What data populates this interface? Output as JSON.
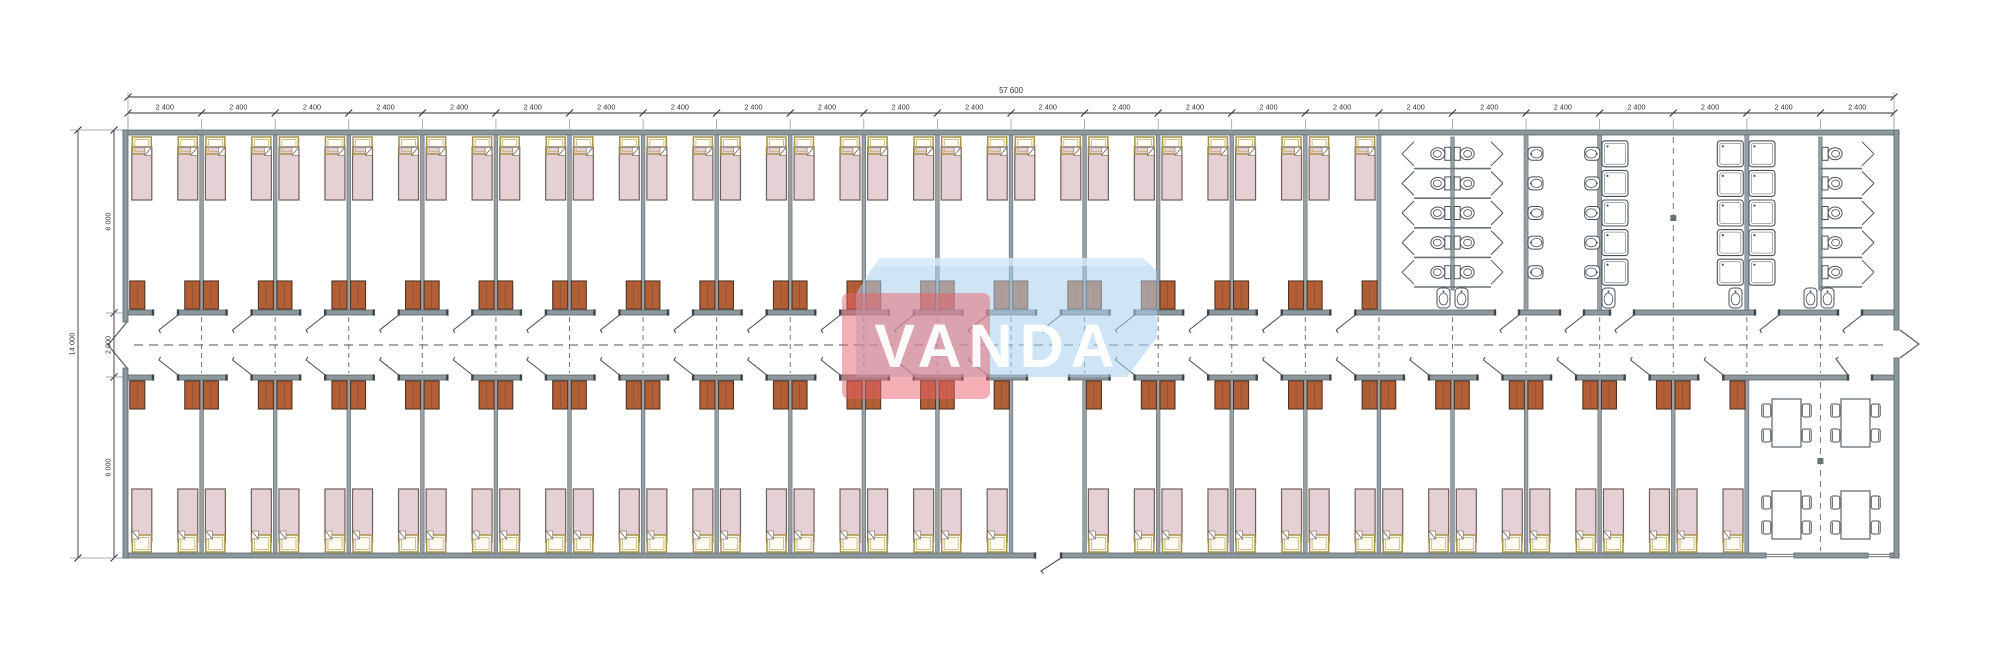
{
  "drawing": {
    "type": "architectural-floor-plan",
    "watermark": {
      "text": "VANDA",
      "red": "#e85f6a",
      "blue": "#a8d0ec",
      "red_rgba": "rgba(232,95,106,0.50)",
      "blue_rgba": "rgba(168,208,236,0.55)",
      "blue_light_rgba": "rgba(225,241,250,0.65)",
      "text_rgba": "rgba(255,255,255,0.95)"
    },
    "dimensions": {
      "top_total": "57 600",
      "module": "2 400",
      "module_count": 24,
      "left_total": "14 000",
      "left_segments": [
        "6 000",
        "2 000",
        "6 000"
      ]
    },
    "colors": {
      "bg": "#ffffff",
      "wall": "#8d989d",
      "wall_edge": "#5a656b",
      "partition": "#98a2a6",
      "partition_edge": "#68737a",
      "line": "#4a5358",
      "bed_fill": "#e5d0d5",
      "bed_stroke": "#6f6054",
      "pillow_fill": "#fdfbf2",
      "pillow_stroke": "#a8924c",
      "cabinet_fill": "#b25f36",
      "cabinet_stroke": "#503424",
      "fixture": "#4a5156",
      "dash": "#70797d",
      "dim": "#2e3336"
    },
    "layout": {
      "top_bedroom_modules": 17,
      "bottom_bedroom_modules": 21,
      "beds_per_room": 2,
      "entrance_module_index": 13,
      "corridor": "central corridor with dashed centerline",
      "sanitary": {
        "wc_stalls_back_to_back": 10,
        "wash_sinks": 10,
        "showers": 15,
        "wc_stalls_single_row": 5,
        "extra_sinks": 6
      },
      "dining": {
        "tables": 4,
        "chairs_per_table": 4
      }
    }
  }
}
